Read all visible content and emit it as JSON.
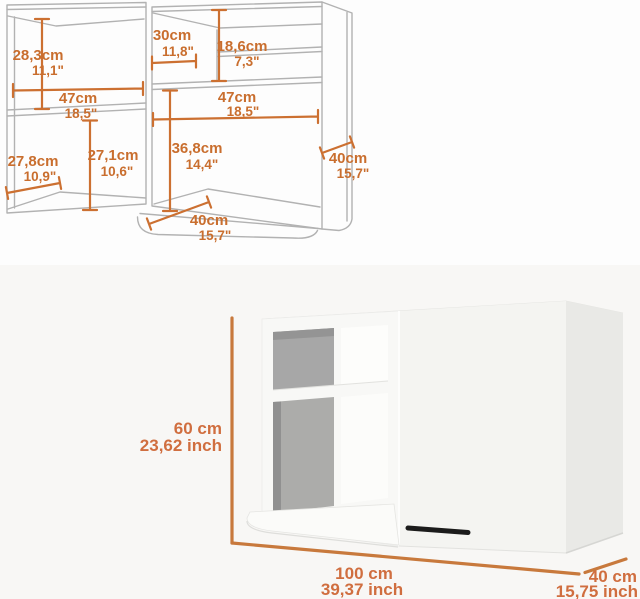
{
  "colors": {
    "dimension_line_orange": "#cc7031",
    "dimension_text_orange": "#c96e2e",
    "photo_dimension_orange": "#c8793c",
    "photo_text_orange": "#d06e3f",
    "drawing_line_gray": "#b2b2b2",
    "photo_background": "#f8f7f5",
    "cabinet_front_white": "#f7f7f5",
    "cabinet_side_gray": "#e9e9e6",
    "interior_back_gray": "#a9a9a9",
    "handle_black": "#1b1b1b"
  },
  "technical_drawing": {
    "dimensions": {
      "left_upper_height": {
        "cm": "28,3cm",
        "inch": "11,1\""
      },
      "left_width": {
        "cm": "47cm",
        "inch": "18,5\""
      },
      "left_lower_depth": {
        "cm": "27,8cm",
        "inch": "10,9\""
      },
      "left_lower_height": {
        "cm": "27,1cm",
        "inch": "10,6\""
      },
      "right_upper_width": {
        "cm": "30cm",
        "inch": "11,8\""
      },
      "right_upper_height": {
        "cm": "18,6cm",
        "inch": "7,3\""
      },
      "right_width": {
        "cm": "47cm",
        "inch": "18,5\""
      },
      "right_lower_height": {
        "cm": "36,8cm",
        "inch": "14,4\""
      },
      "bottom_depth": {
        "cm": "40cm",
        "inch": "15,7\""
      },
      "side_depth": {
        "cm": "40cm",
        "inch": "15,7\""
      }
    }
  },
  "product_photo": {
    "dimensions": {
      "height": {
        "cm": "60 cm",
        "inch": "23,62 inch"
      },
      "width": {
        "cm": "100 cm",
        "inch": "39,37 inch"
      },
      "depth": {
        "cm": "40 cm",
        "inch": "15,75 inch"
      }
    }
  }
}
